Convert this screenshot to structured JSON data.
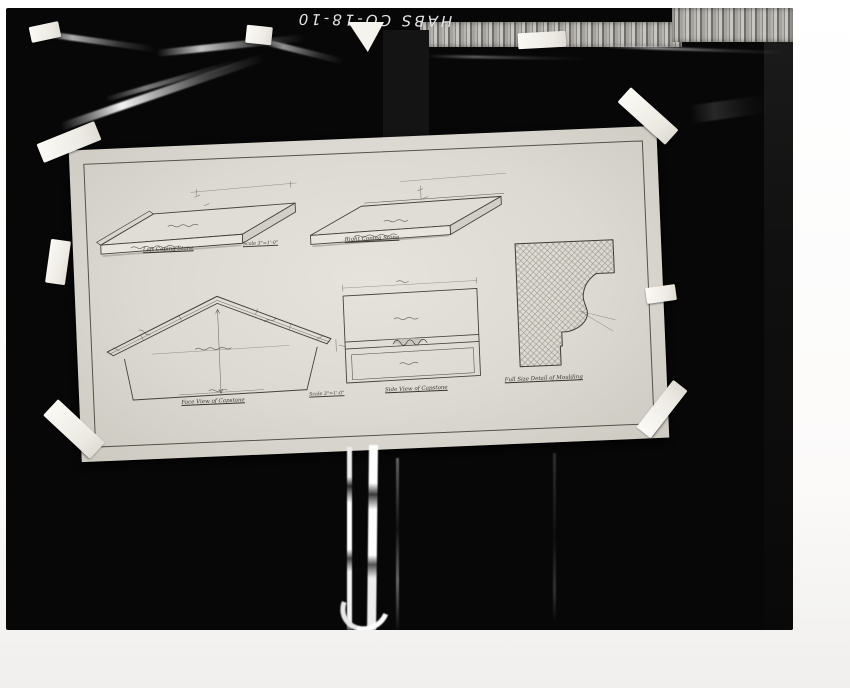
{
  "photo_id": "HABS CO-18-10",
  "captions": {
    "left_coping": "Left Coping Stone",
    "scale_upper": "Scale 3\"=1'-0\"",
    "right_coping": "Right Coping Stone",
    "face_view": "Face View of Capstone",
    "scale_lower": "Scale 3\"=1'-0\"",
    "side_view": "Side View of Capstone",
    "moulding_detail": "Full Size Detail of Moulding"
  },
  "colors": {
    "backdrop": "#070707",
    "paper": "#dcd9d2",
    "tape": "#f4f3ee",
    "ink": "#3f3d37"
  }
}
